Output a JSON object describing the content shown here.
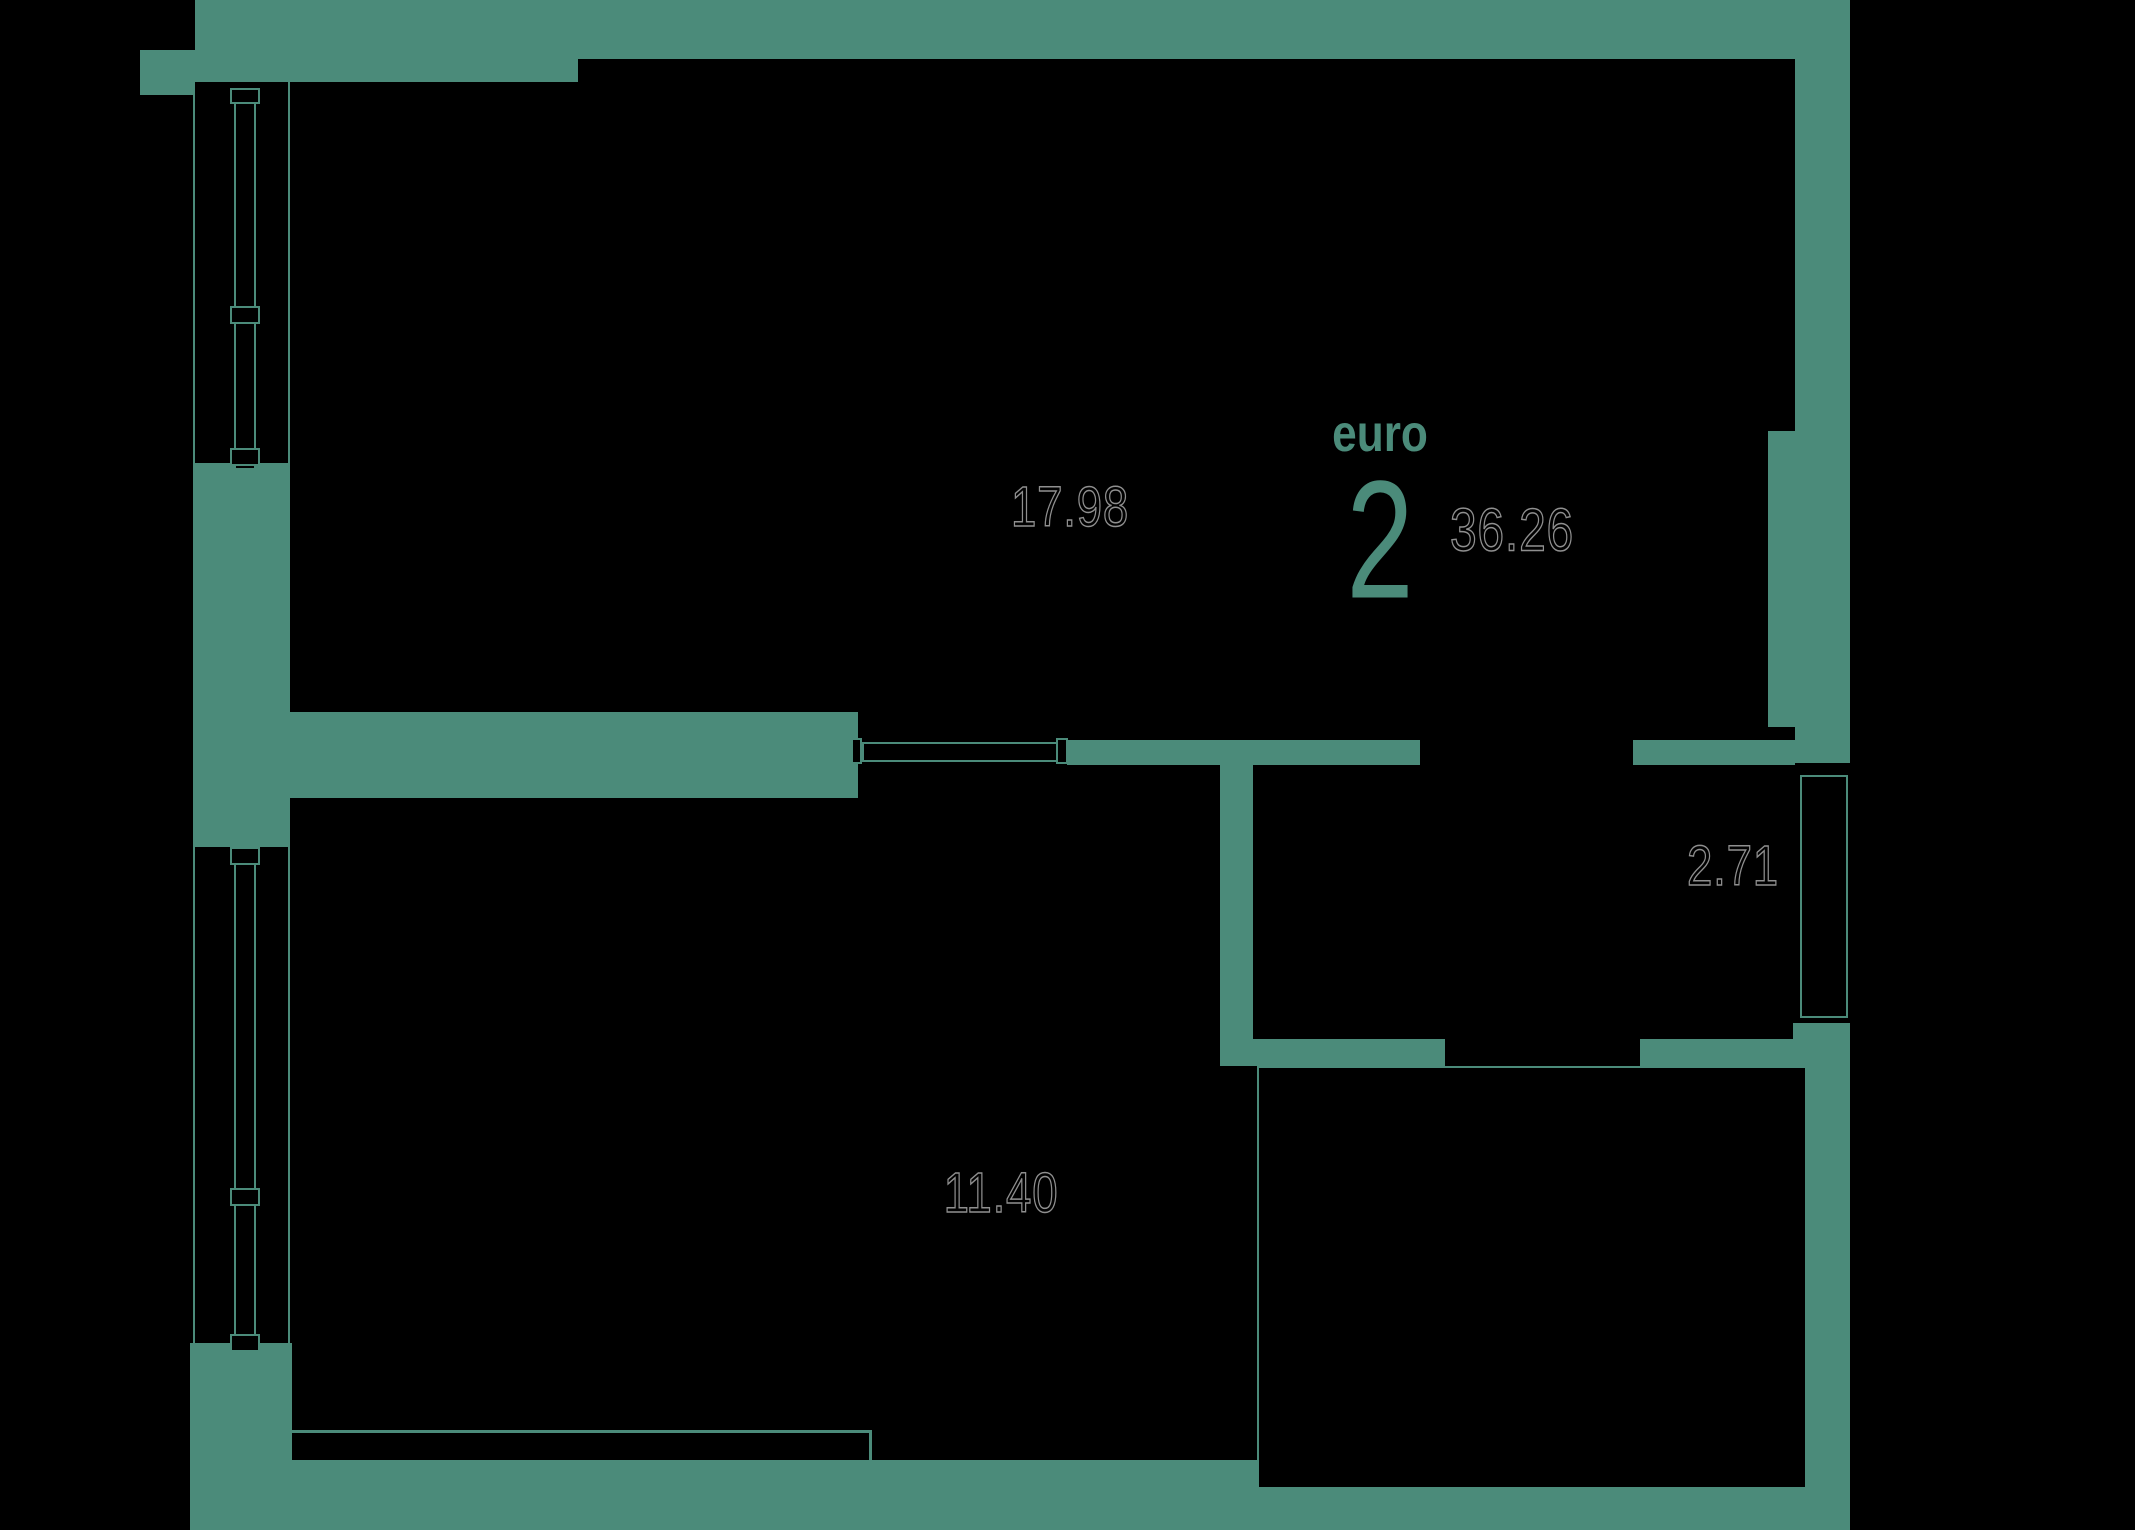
{
  "plan": {
    "background_color": "#000000",
    "wall_color": "#4b8b7a",
    "label_outline_color": "#8f8f8f",
    "label_fill_color": "#000000",
    "apartment": {
      "type_label": "euro",
      "rooms_count": "2",
      "total_area": "36.26",
      "type_x": 1380,
      "type_y": 434,
      "count_x": 1380,
      "count_y": 540,
      "area_x": 1512,
      "area_y": 530
    },
    "rooms": [
      {
        "name": "living-room",
        "area": "17.98",
        "cx": 1070,
        "cy": 507
      },
      {
        "name": "bedroom",
        "area": "11.40",
        "cx": 1001,
        "cy": 1193
      },
      {
        "name": "hallway",
        "area": "2.71",
        "cx": 1733,
        "cy": 866
      },
      {
        "name": "bathroom",
        "area": "4.17",
        "cx": 1542,
        "cy": 1258
      }
    ],
    "walls": [
      {
        "name": "top-wall-left-thick",
        "x": 195,
        "y": 0,
        "w": 383,
        "h": 82
      },
      {
        "name": "top-wall-right",
        "x": 578,
        "y": 0,
        "w": 1272,
        "h": 59
      },
      {
        "name": "left-top-corner-step",
        "x": 140,
        "y": 50,
        "w": 55,
        "h": 45
      },
      {
        "name": "left-wall-pier",
        "x": 195,
        "y": 463,
        "w": 95,
        "h": 384
      },
      {
        "name": "left-bottom-corner",
        "x": 190,
        "y": 1343,
        "w": 102,
        "h": 187
      },
      {
        "name": "bottom-wall",
        "x": 190,
        "y": 1460,
        "w": 1410,
        "h": 70
      },
      {
        "name": "right-wall-top",
        "x": 1795,
        "y": 0,
        "w": 55,
        "h": 431
      },
      {
        "name": "right-wall-pier",
        "x": 1768,
        "y": 431,
        "w": 82,
        "h": 296
      },
      {
        "name": "right-wall-mid",
        "x": 1795,
        "y": 727,
        "w": 55,
        "h": 36
      },
      {
        "name": "right-wall-low",
        "x": 1793,
        "y": 1023,
        "w": 57,
        "h": 507
      },
      {
        "name": "living-bedroom-wall",
        "x": 195,
        "y": 712,
        "w": 663,
        "h": 86
      },
      {
        "name": "corridor-wall-left",
        "x": 1067,
        "y": 740,
        "w": 353,
        "h": 25
      },
      {
        "name": "corridor-wall-right",
        "x": 1633,
        "y": 740,
        "w": 162,
        "h": 25
      },
      {
        "name": "hall-bath-wall-vertical",
        "x": 1220,
        "y": 740,
        "w": 33,
        "h": 326
      },
      {
        "name": "bath-wall-left",
        "x": 1220,
        "y": 1039,
        "w": 225,
        "h": 27
      },
      {
        "name": "bath-wall-right",
        "x": 1640,
        "y": 1039,
        "w": 184,
        "h": 27
      },
      {
        "name": "shaft-band-top",
        "x": 1600,
        "y": 1423,
        "w": 198,
        "h": 24
      },
      {
        "name": "shaft-stub",
        "x": 1600,
        "y": 1423,
        "w": 25,
        "h": 107
      },
      {
        "name": "shaft-fill-bottom",
        "x": 1600,
        "y": 1475,
        "w": 198,
        "h": 55
      }
    ],
    "lines": [
      {
        "name": "left-wall-outer-face",
        "x": 193,
        "y": 95,
        "w": 2,
        "h": 1248
      },
      {
        "name": "left-wall-inner-face-up",
        "x": 288,
        "y": 82,
        "w": 2,
        "h": 630
      },
      {
        "name": "left-wall-inner-face-low",
        "x": 288,
        "y": 798,
        "w": 2,
        "h": 662
      },
      {
        "name": "bedroom-bottom-face",
        "x": 290,
        "y": 1430,
        "w": 581,
        "h": 3
      },
      {
        "name": "bedroom-bottom-face-step",
        "x": 869,
        "y": 1430,
        "w": 3,
        "h": 32
      },
      {
        "name": "bath-door-threshold",
        "x": 1445,
        "y": 1068,
        "w": 195,
        "h": 3
      },
      {
        "name": "window-1-glazing",
        "x": 244,
        "y": 104,
        "w": 2,
        "h": 344
      },
      {
        "name": "window-2-glazing",
        "x": 244,
        "y": 865,
        "w": 2,
        "h": 467
      },
      {
        "name": "window-3-glazing",
        "x": 1823,
        "y": 777,
        "w": 2,
        "h": 239
      }
    ],
    "outlines": [
      {
        "name": "window-1-frame",
        "x": 234,
        "y": 88,
        "w": 22,
        "h": 382
      },
      {
        "name": "window-1-block-top",
        "x": 230,
        "y": 88,
        "w": 30,
        "h": 16
      },
      {
        "name": "window-1-block-handle",
        "x": 230,
        "y": 306,
        "w": 30,
        "h": 18
      },
      {
        "name": "window-1-block-bottom",
        "x": 230,
        "y": 448,
        "w": 30,
        "h": 18
      },
      {
        "name": "window-2-frame",
        "x": 234,
        "y": 847,
        "w": 22,
        "h": 505
      },
      {
        "name": "window-2-block-top",
        "x": 230,
        "y": 847,
        "w": 30,
        "h": 18
      },
      {
        "name": "window-2-block-handle",
        "x": 230,
        "y": 1188,
        "w": 30,
        "h": 18
      },
      {
        "name": "window-2-block-bottom",
        "x": 230,
        "y": 1334,
        "w": 30,
        "h": 18
      },
      {
        "name": "window-3-frame",
        "x": 1800,
        "y": 775,
        "w": 48,
        "h": 243
      },
      {
        "name": "door-leaf",
        "x": 862,
        "y": 742,
        "w": 200,
        "h": 20
      },
      {
        "name": "door-jamb-left",
        "x": 851,
        "y": 738,
        "w": 11,
        "h": 26
      },
      {
        "name": "door-jamb-right",
        "x": 1056,
        "y": 738,
        "w": 12,
        "h": 26
      },
      {
        "name": "bathroom-inner-outline",
        "x": 1257,
        "y": 1066,
        "w": 550,
        "h": 423
      }
    ]
  }
}
